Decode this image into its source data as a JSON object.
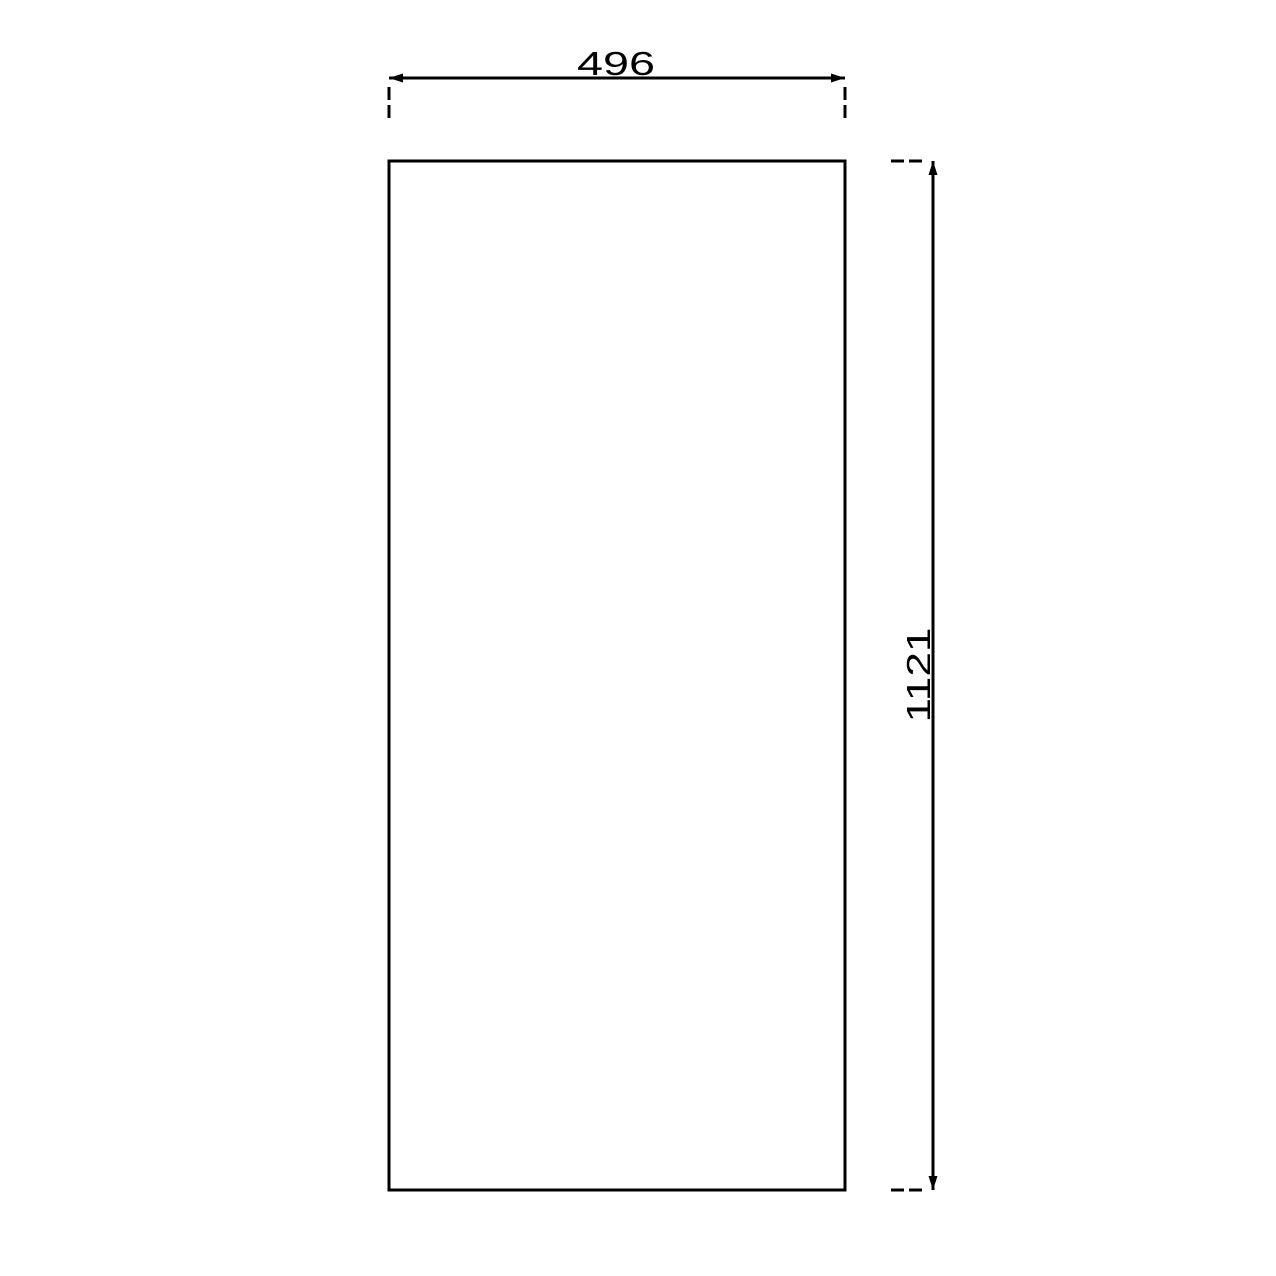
{
  "drawing": {
    "type": "cad-dimension-drawing",
    "background_color": "#ffffff",
    "line_color": "#000000",
    "shape": "rectangle-panel-outline",
    "dimensions": {
      "width": {
        "value": "496"
      },
      "height": {
        "value": "1121"
      }
    }
  }
}
